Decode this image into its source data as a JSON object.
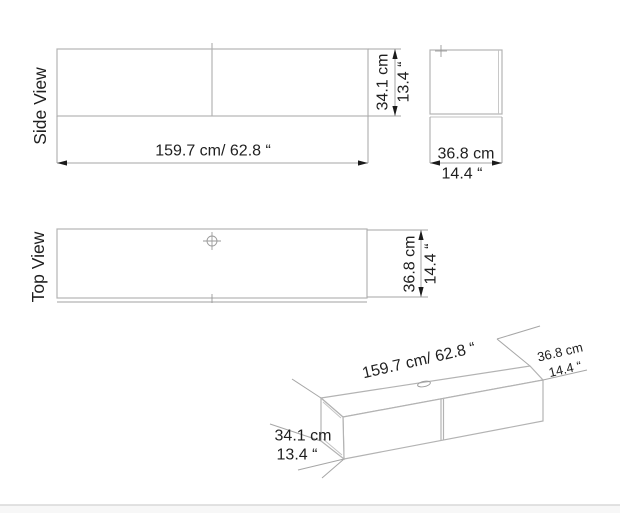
{
  "colors": {
    "background": "#ffffff",
    "outline": "#b3b3b3",
    "extension_line": "#a6a6a6",
    "arrow": "#1b1b1b",
    "text": "#1f1f1f",
    "footer_line": "#d9d9d9",
    "footer_bg": "#f7f7f7"
  },
  "side_view": {
    "label": "Side View",
    "length": "159.7 cm/ 62.8 “",
    "height_cm": "34.1 cm",
    "height_in": "13.4 “"
  },
  "end_view": {
    "width_cm": "36.8 cm",
    "width_in": "14.4 “"
  },
  "top_view": {
    "label": "Top View",
    "depth_cm": "36.8 cm",
    "depth_in": "14.4 “"
  },
  "iso_view": {
    "length": "159.7 cm/ 62.8 “",
    "depth_cm": "36.8 cm",
    "depth_in": "14.4 “",
    "height_cm": "34.1 cm",
    "height_in": "13.4 “"
  }
}
